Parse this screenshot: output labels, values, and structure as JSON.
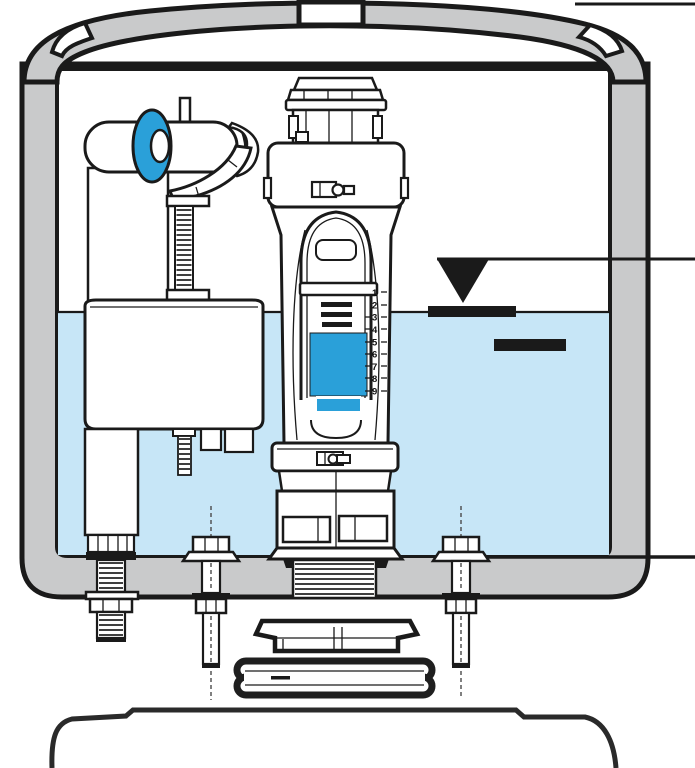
{
  "colors": {
    "outline": "#1a1a1a",
    "porcelain": "#c9cacb",
    "water": "#c7e6f7",
    "accent_blue": "#2aa0d9",
    "white": "#ffffff"
  },
  "flush_valve": {
    "scale_labels": [
      "1",
      "2",
      "3",
      "4",
      "5",
      "6",
      "7",
      "8",
      "9"
    ]
  },
  "markers": {
    "water_level_symbol": "filled-triangle-down",
    "leader_line_count": "3"
  }
}
